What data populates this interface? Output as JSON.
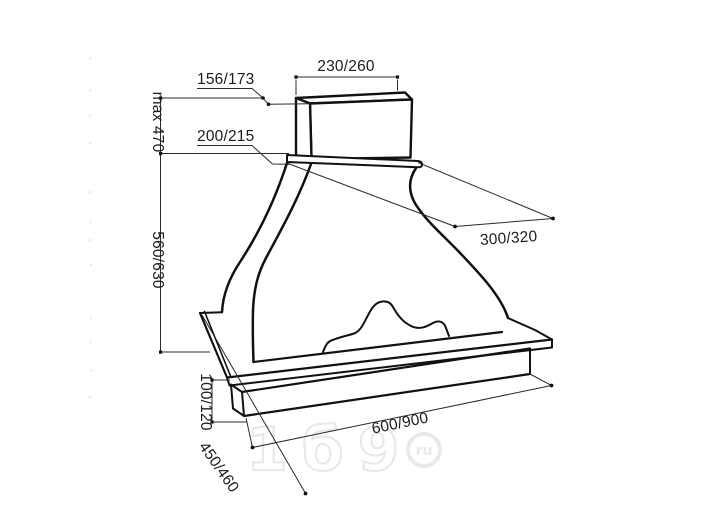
{
  "diagram": {
    "labels": {
      "top_width": "230/260",
      "top_depth": "156/173",
      "upper_height_max": "max 470",
      "collar_depth": "200/215",
      "duct_depth": "300/320",
      "body_height": "560/630",
      "base_height": "100/120",
      "base_depth": "450/460",
      "base_width": "600/900"
    },
    "watermark": {
      "text": "1б9",
      "badge": "ru"
    },
    "colors": {
      "line": "#111111",
      "dimension_line": "#2b2b2b",
      "text": "#1c1c1c",
      "watermark": "#e9e9e9",
      "background": "#ffffff"
    }
  }
}
